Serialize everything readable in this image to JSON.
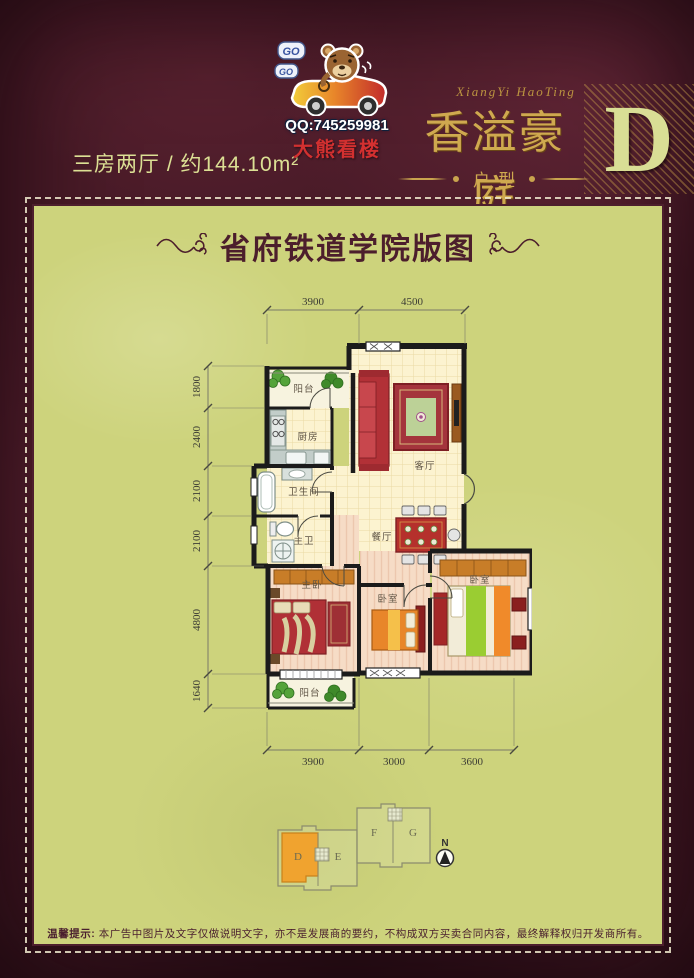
{
  "header": {
    "logo": {
      "bubble1": "GO",
      "bubble2": "GO",
      "qq": "QQ:745259981",
      "watermark": "大熊看楼"
    },
    "subtitle": "三房两厅 / 约144.10m²",
    "brand": {
      "script": "XiangYi HaoTing",
      "name": "香溢豪庭",
      "category": "户型",
      "unit_letter": "D"
    }
  },
  "panel": {
    "title": "省府铁道学院版图",
    "floorplan": {
      "dims": {
        "top": [
          "3900",
          "4500"
        ],
        "left": [
          "1800",
          "2400",
          "2100",
          "2100",
          "4800",
          "1640"
        ],
        "bottom": [
          "3900",
          "3000",
          "3600"
        ]
      },
      "rooms": {
        "balcony_top": "阳台",
        "kitchen": "厨房",
        "living": "客厅",
        "bath": "卫生间",
        "master_bath": "主卫",
        "dining": "餐厅",
        "master_bed": "主卧",
        "bedroom2": "卧室",
        "bedroom3": "卧室",
        "balcony_bottom": "阳台"
      }
    },
    "keyplan": {
      "units": [
        "D",
        "E",
        "F",
        "G"
      ],
      "compass": "N"
    },
    "disclaimer": {
      "label": "温馨提示:",
      "text": "本广告中图片及文字仅做说明文字，亦不是发展商的要约，不构成双方买卖合同内容，最终解释权归开发商所有。"
    }
  },
  "colors": {
    "background_maroon": "#4a1b28",
    "panel_green": "#cdd37c",
    "gold": "#c9a44e",
    "light_yellow_text": "#dce094",
    "unit_highlight_orange": "#f0a32f",
    "watermark_red": "#d23030"
  }
}
